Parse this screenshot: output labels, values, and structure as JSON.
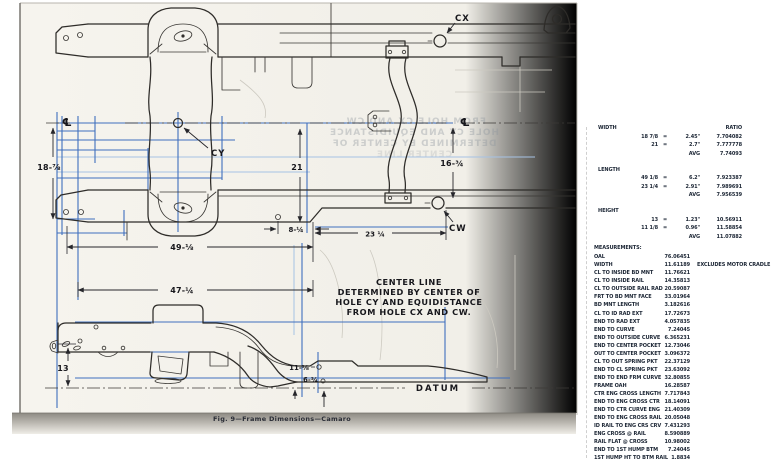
{
  "diagram": {
    "caption": "Fig. 9—Frame Dimensions—Camaro",
    "labels": {
      "cx": "CX",
      "cy": "CY",
      "cw": "CW",
      "centerline": "℄",
      "datum": "DATUM"
    },
    "note": {
      "line1": "CENTER LINE",
      "line2": "DETERMINED BY CENTER OF",
      "line3": "HOLE CY AND EQUIDISTANCE",
      "line4": "FROM HOLE CX AND CW."
    },
    "dims": {
      "d18": "18-⅞",
      "d21": "21",
      "d16": "16-¾",
      "d8": "8-¼",
      "d23": "23 ¼",
      "d49": "49-⅛",
      "d47": "47-¼",
      "d13": "13",
      "d11": "11-⅛",
      "d6": "6-¾"
    }
  },
  "ratio_table": {
    "ratio_header": "RATIO",
    "sections": [
      {
        "label": "WIDTH",
        "rows": [
          {
            "c1": "18 7/8",
            "eq": "=",
            "c2": "2.45\"",
            "c3": "7.704082"
          },
          {
            "c1": "21",
            "eq": "=",
            "c2": "2.7\"",
            "c3": "7.777778"
          },
          {
            "c1": "",
            "eq": "",
            "c2": "AVG",
            "c3": "7.74093"
          }
        ]
      },
      {
        "label": "LENGTH",
        "rows": [
          {
            "c1": "49 1/8",
            "eq": "=",
            "c2": "6.2\"",
            "c3": "7.923387"
          },
          {
            "c1": "23 1/4",
            "eq": "=",
            "c2": "2.91\"",
            "c3": "7.989691"
          },
          {
            "c1": "",
            "eq": "",
            "c2": "AVG",
            "c3": "7.956539"
          }
        ]
      },
      {
        "label": "HEIGHT",
        "rows": [
          {
            "c1": "13",
            "eq": "=",
            "c2": "1.23\"",
            "c3": "10.56911"
          },
          {
            "c1": "11 1/8",
            "eq": "=",
            "c2": "0.96\"",
            "c3": "11.58854"
          },
          {
            "c1": "",
            "eq": "",
            "c2": "AVG",
            "c3": "11.07882"
          }
        ]
      }
    ]
  },
  "measurements": {
    "title": "MEASUREMENTS:",
    "rows": [
      {
        "name": "OAL",
        "value": "76.06451",
        "note": ""
      },
      {
        "name": "WIDTH",
        "value": "11.61189",
        "note": "EXCLUDES MOTOR CRADLE"
      },
      {
        "name": "CL TO INSIDE BD MNT",
        "value": "11.76621",
        "note": ""
      },
      {
        "name": "CL TO INSIDE RAIL",
        "value": "14.35813",
        "note": ""
      },
      {
        "name": "CL TO OUTSIDE RAIL RAD",
        "value": "20.59087",
        "note": ""
      },
      {
        "name": "FRT TO BD MNT FACE",
        "value": "33.01964",
        "note": ""
      },
      {
        "name": "BD MNT LENGTH",
        "value": "3.182616",
        "note": ""
      },
      {
        "name": "CL TO ID RAD EXT",
        "value": "17.72673",
        "note": ""
      },
      {
        "name": "END TO RAD EXT",
        "value": "4.057835",
        "note": ""
      },
      {
        "name": "END TO CURVE",
        "value": "7.24045",
        "note": ""
      },
      {
        "name": "END TO OUTSIDE CURVE",
        "value": "6.365231",
        "note": ""
      },
      {
        "name": "END TO CENTER POCKET",
        "value": "12.73046",
        "note": ""
      },
      {
        "name": "OUT TO CENTER POCKET",
        "value": "3.096372",
        "note": ""
      },
      {
        "name": "CL TO OUT SPRING PKT",
        "value": "22.37129",
        "note": ""
      },
      {
        "name": "END TO CL SPRING PKT",
        "value": "23.63092",
        "note": ""
      },
      {
        "name": "END TO END FRM CURVE",
        "value": "32.80855",
        "note": ""
      },
      {
        "name": "FRAME OAH",
        "value": "16.28587",
        "note": ""
      },
      {
        "name": "CTR ENG CROSS LENGTH",
        "value": "7.717843",
        "note": ""
      },
      {
        "name": "END TO ENG CROSS CTR",
        "value": "18.14091",
        "note": ""
      },
      {
        "name": "END TO CTR CURVE ENG",
        "value": "21.40309",
        "note": ""
      },
      {
        "name": "END TO ENG CROSS RAIL",
        "value": "20.05048",
        "note": ""
      },
      {
        "name": "ID RAIL TO ENG CRS CRV",
        "value": "7.431293",
        "note": ""
      },
      {
        "name": "ENG CROSS @ RAIL",
        "value": "8.590889",
        "note": ""
      },
      {
        "name": "RAIL FLAT @ CROSS",
        "value": "10.98002",
        "note": ""
      },
      {
        "name": "END TO 1ST HUMP BTM",
        "value": "7.24045",
        "note": ""
      },
      {
        "name": "1ST HUMP HT TO BTM RAIL",
        "value": "1.8834",
        "note": ""
      }
    ]
  }
}
